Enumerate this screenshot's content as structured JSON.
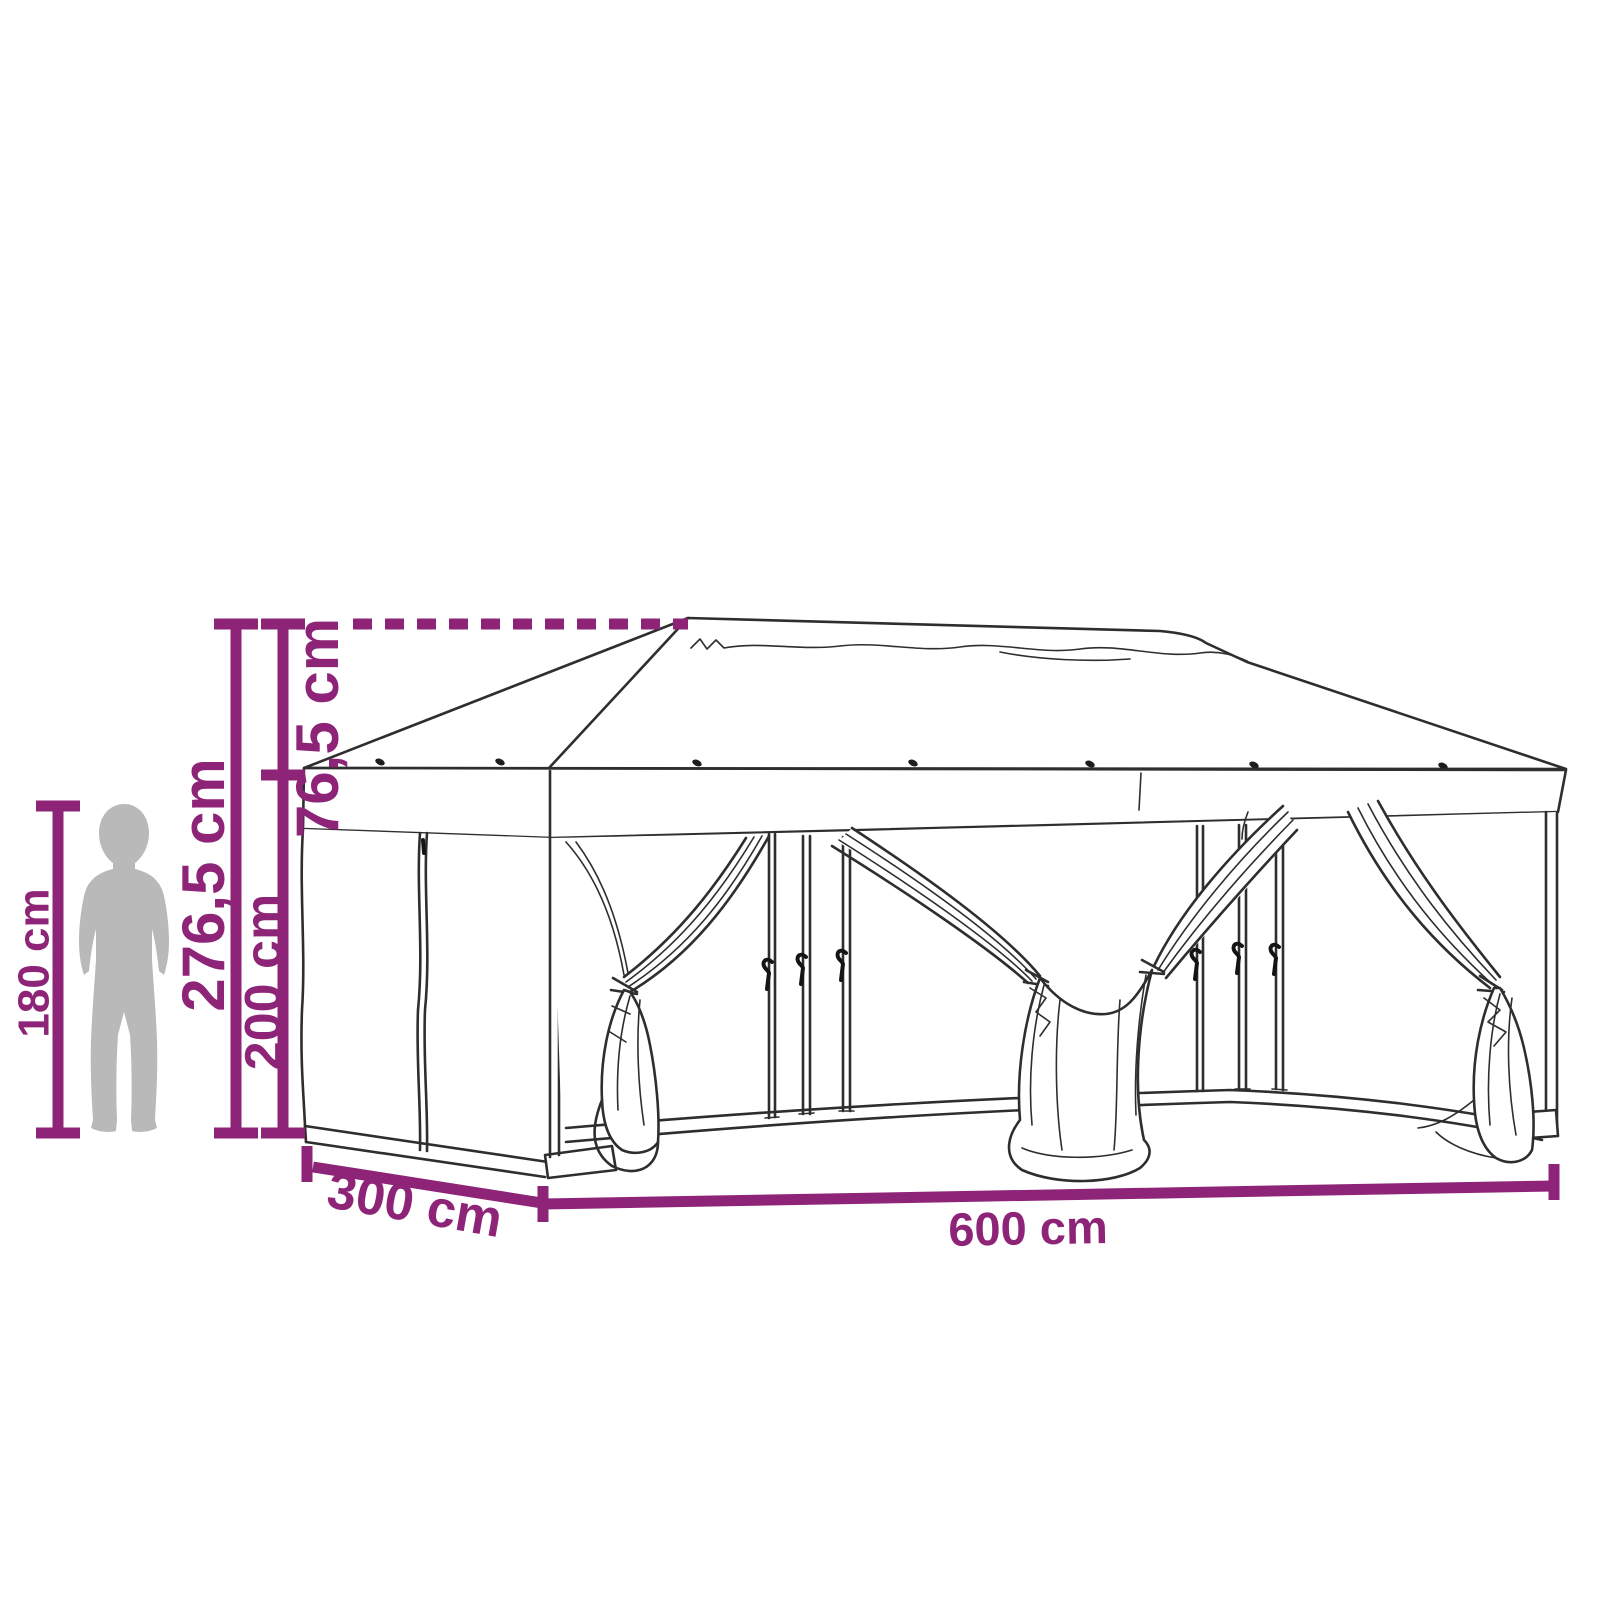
{
  "diagram": {
    "type": "product-dimension-line-drawing",
    "subject": "pop-up party tent gazebo with mesh sidewalls and tied-back curtains, shown with human silhouette for scale",
    "background_color": "#FFFFFF",
    "accent_color": "#8E2478",
    "outline_color": "#2E2E2E",
    "silhouette_color": "#B9B9B9",
    "labels": {
      "roof_height": "76,5 cm",
      "total_height": "276,5 cm",
      "wall_height": "200 cm",
      "person_height": "180 cm",
      "depth": "300 cm",
      "width": "600 cm"
    }
  }
}
